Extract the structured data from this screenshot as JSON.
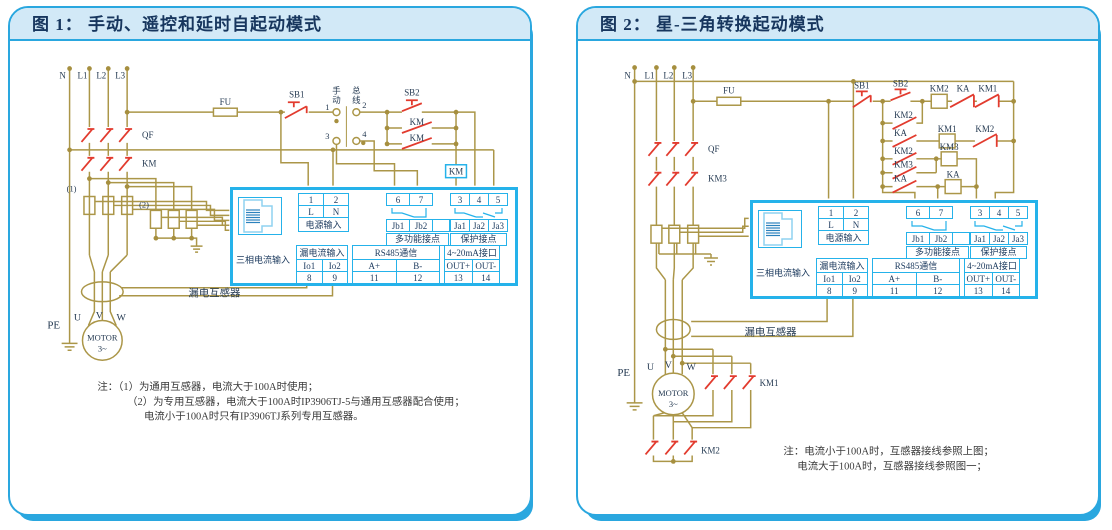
{
  "panel1": {
    "title": "图 1：  手动、遥控和延时自起动模式",
    "labels": {
      "n": "N",
      "l1": "L1",
      "l2": "L2",
      "l3": "L3",
      "fu": "FU",
      "qf": "QF",
      "km": "KM",
      "sb1": "SB1",
      "sb2": "SB2",
      "km_r2": "KM",
      "km_r3": "KM",
      "km_coil": "KM",
      "sel_m1": "手",
      "sel_m2": "动",
      "sel_b1": "总",
      "sel_b2": "线",
      "sel_t1": "1",
      "sel_t2": "2",
      "sel_t3": "3",
      "sel_t4": "4",
      "ct1": "(1)",
      "ct2": "(2)",
      "leakage": "漏电互感器",
      "pe": "PE",
      "u": "U",
      "v": "V",
      "w": "W",
      "motor": "MOTOR",
      "motor_ph": "3~"
    },
    "notes": [
      "注：（1）为通用互感器，电流大于100A时使用；",
      "（2）为专用互感器，电流大于100A时IP3906TJ-5与通用互感器配合使用；",
      "电流小于100A时只有IP3906TJ系列专用互感器。"
    ]
  },
  "panel2": {
    "title": "图 2：  星-三角转换起动模式",
    "labels": {
      "n": "N",
      "l1": "L1",
      "l2": "L2",
      "l3": "L3",
      "fu": "FU",
      "qf": "QF",
      "km3": "KM3",
      "sb1": "SB1",
      "sb2": "SB2",
      "km2_coil": "KM2",
      "ka_top": "KA",
      "km1_top": "KM1",
      "r2_km2": "KM2",
      "r3_ka": "KA",
      "r3_km1": "KM1",
      "r3_km2": "KM2",
      "r4_km2": "KM2",
      "r4_km3": "KM3",
      "r5_km3": "KM3",
      "r6_ka": "KA",
      "r6_ka_coil": "KA",
      "leakage": "漏电互感器",
      "pe": "PE",
      "u": "U",
      "v": "V",
      "w": "W",
      "motor": "MOTOR",
      "motor_ph": "3~",
      "km1_main": "KM1",
      "km2_main": "KM2"
    },
    "notes": [
      "注：电流小于100A时，互感器接线参照上图；",
      "电流大于100A时，互感器接线参照图一；"
    ]
  },
  "device": {
    "ct_label": "三相电流输入",
    "power": {
      "n1": "1",
      "n2": "2",
      "l": "L",
      "n": "N",
      "header": "电源输入"
    },
    "multi": {
      "n6": "6",
      "n7": "7",
      "jb1": "Jb1",
      "jb2": "Jb2",
      "header": "多功能接点"
    },
    "prot": {
      "n3": "3",
      "n4": "4",
      "n5": "5",
      "ja1": "Ja1",
      "ja2": "Ja2",
      "ja3": "Ja3",
      "header": "保护接点"
    },
    "leak": {
      "header": "漏电流输入",
      "io1": "Io1",
      "io2": "Io2",
      "n8": "8",
      "n9": "9"
    },
    "rs485": {
      "header": "RS485通信",
      "ap": "A+",
      "bm": "B-",
      "n11": "11",
      "n12": "12"
    },
    "ma": {
      "header": "4~20mA接口",
      "outp": "OUT+",
      "outm": "OUT-",
      "n13": "13",
      "n14": "14"
    }
  },
  "colors": {
    "panel_blue": "#2aa7df",
    "box_cyan": "#25b2ea",
    "wire_tan": "#ab9648",
    "contact_red": "#e23b2e",
    "title_bg": "#d2e9f7",
    "text_navy": "#1c3a5e"
  }
}
